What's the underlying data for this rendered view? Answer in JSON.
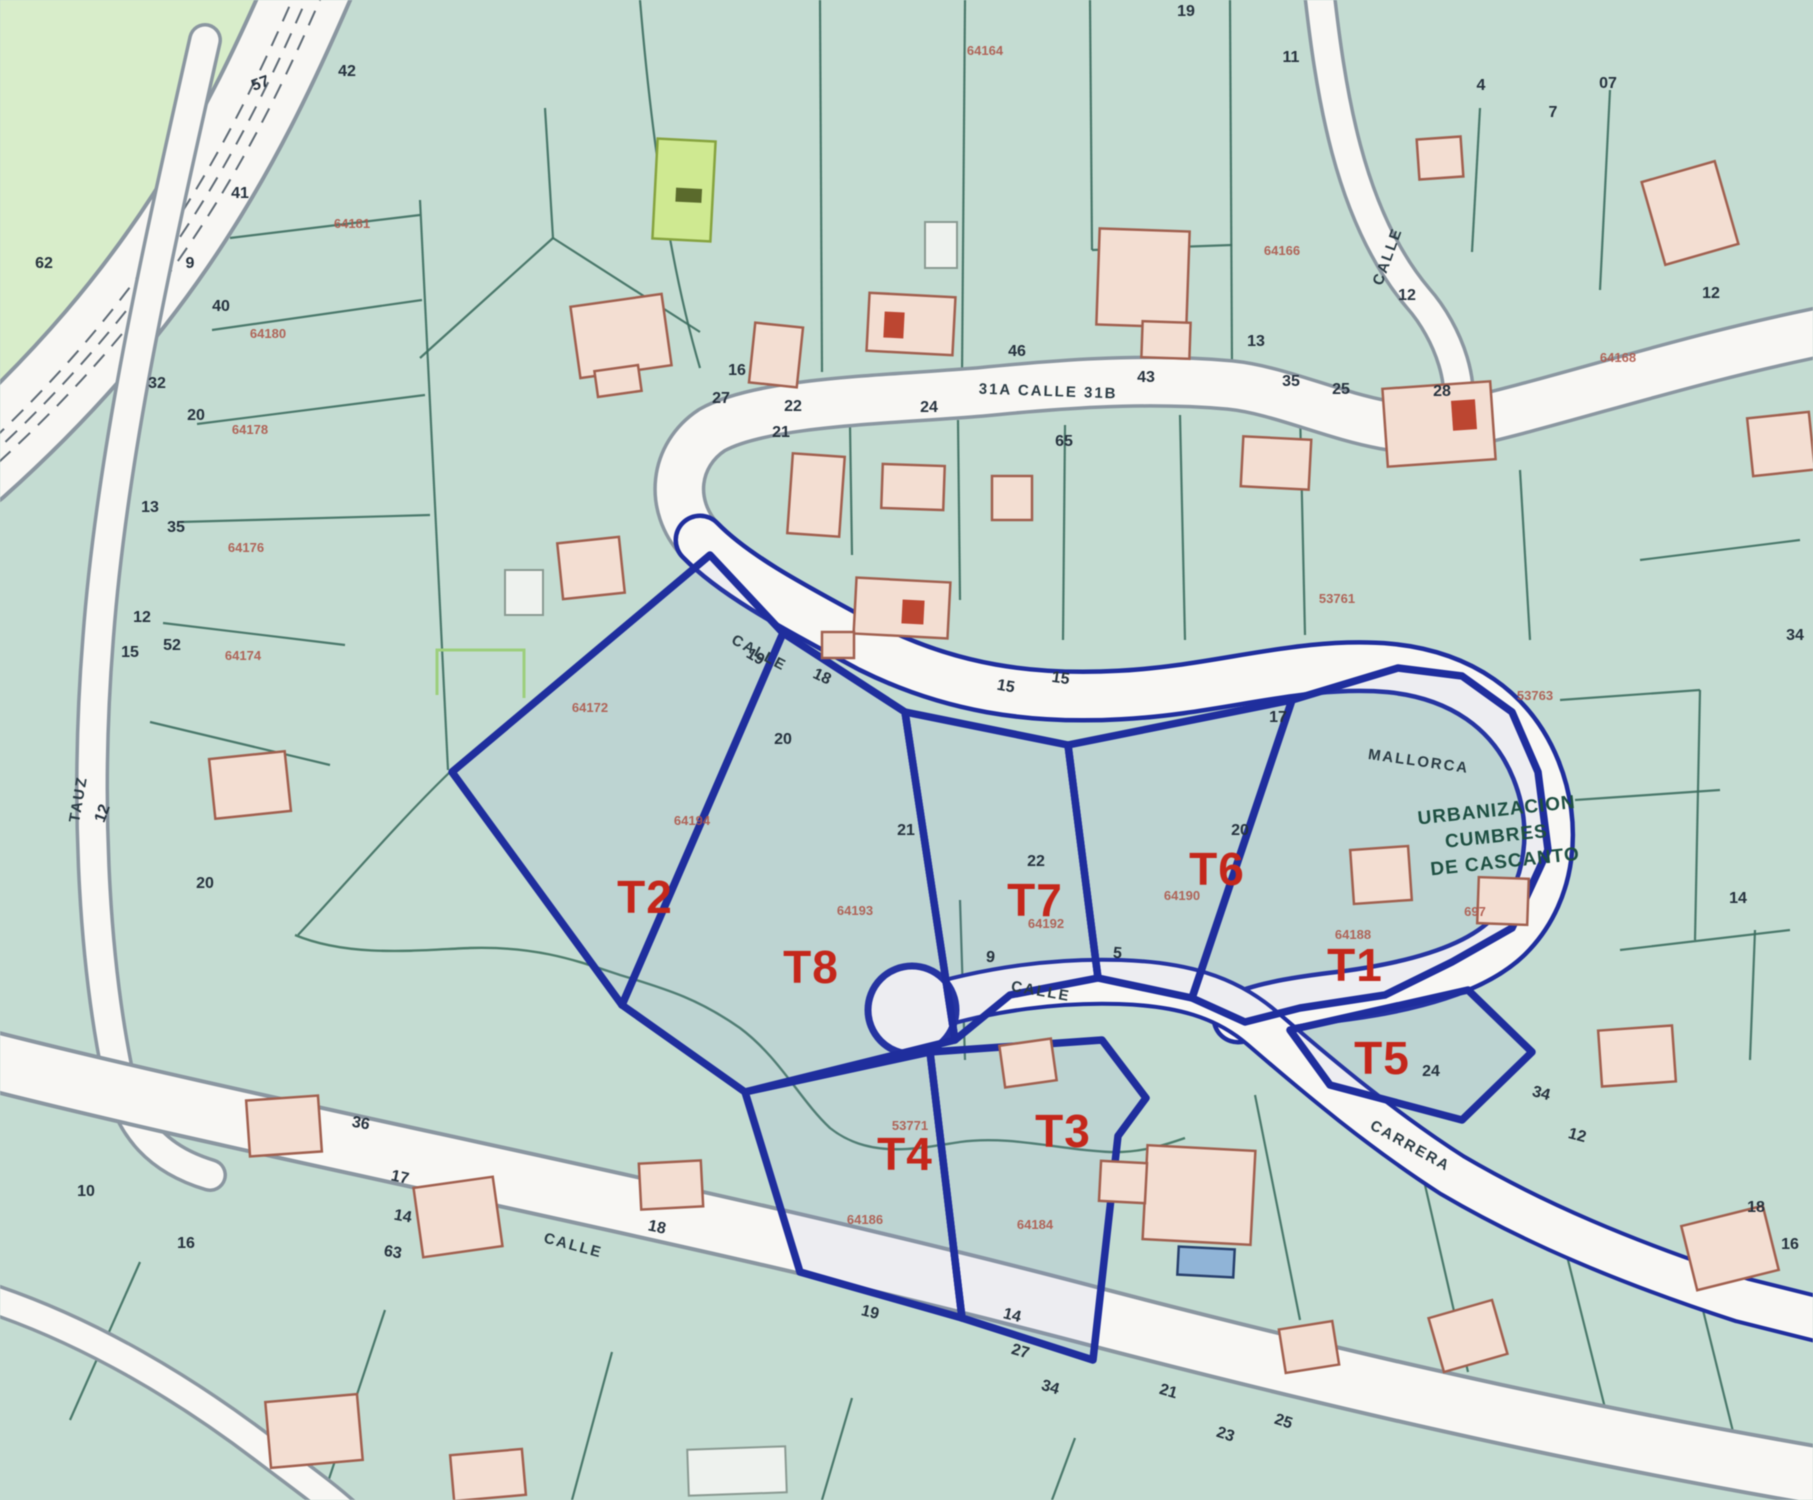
{
  "map": {
    "region_lines": [
      "URBANIZACION",
      "CUMBRES",
      "DE CASCANTO"
    ],
    "colors": {
      "background": "#c3dcd2",
      "road": "#f8f7f4",
      "plot_boundary_blue": "#1e2ea0",
      "plot_label_red": "#c8261a",
      "parcel_code_red": "#b0584a",
      "parcel_code_purple": "#8b7fd2",
      "building_fill": "#f4ded2",
      "building_stroke": "#a2604e",
      "highlight_parcel_green": "#cfe98f",
      "region_text_green": "#1d4f42"
    },
    "plot_labels": [
      {
        "t": "T1",
        "x": 1355,
        "y": 981
      },
      {
        "t": "T2",
        "x": 645,
        "y": 913
      },
      {
        "t": "T3",
        "x": 1063,
        "y": 1147
      },
      {
        "t": "T4",
        "x": 905,
        "y": 1170
      },
      {
        "t": "T5",
        "x": 1382,
        "y": 1074,
        "s": 42
      },
      {
        "t": "T6",
        "x": 1217,
        "y": 885
      },
      {
        "t": "T7",
        "x": 1035,
        "y": 916
      },
      {
        "t": "T8",
        "x": 811,
        "y": 983
      }
    ],
    "street_labels": [
      {
        "t": "CALLE",
        "x": 757,
        "y": 657,
        "r": 28
      },
      {
        "t": "31A CALLE 31B",
        "x": 1048,
        "y": 396,
        "r": 2
      },
      {
        "t": "MALLORCA",
        "x": 1418,
        "y": 766,
        "r": 8,
        "s": 20
      },
      {
        "t": "CALLE",
        "x": 1040,
        "y": 996,
        "r": 10
      },
      {
        "t": "CARRERA",
        "x": 1408,
        "y": 1150,
        "r": 29
      },
      {
        "t": "CALLE",
        "x": 572,
        "y": 1250,
        "r": 15,
        "s": 16
      },
      {
        "t": "CALLE",
        "x": 1392,
        "y": 258,
        "r": -70,
        "s": 14
      },
      {
        "t": "TAUZ",
        "x": 83,
        "y": 800,
        "r": -80,
        "s": 14
      }
    ],
    "street_numbers": [
      {
        "t": "57",
        "x": 262,
        "y": 88,
        "r": -20
      },
      {
        "t": "42",
        "x": 347,
        "y": 76
      },
      {
        "t": "41",
        "x": 240,
        "y": 198
      },
      {
        "t": "40",
        "x": 221,
        "y": 311
      },
      {
        "t": "20",
        "x": 196,
        "y": 420
      },
      {
        "t": "32",
        "x": 157,
        "y": 388
      },
      {
        "t": "13",
        "x": 150,
        "y": 512
      },
      {
        "t": "35",
        "x": 176,
        "y": 532
      },
      {
        "t": "12",
        "x": 142,
        "y": 622
      },
      {
        "t": "52",
        "x": 172,
        "y": 650
      },
      {
        "t": "15",
        "x": 130,
        "y": 657
      },
      {
        "t": "62",
        "x": 44,
        "y": 268
      },
      {
        "t": "9",
        "x": 190,
        "y": 268
      },
      {
        "t": "12",
        "x": 107,
        "y": 815,
        "r": -70
      },
      {
        "t": "20",
        "x": 205,
        "y": 888
      },
      {
        "t": "16",
        "x": 737,
        "y": 375
      },
      {
        "t": "27",
        "x": 721,
        "y": 403
      },
      {
        "t": "22",
        "x": 793,
        "y": 411
      },
      {
        "t": "21",
        "x": 781,
        "y": 437
      },
      {
        "t": "24",
        "x": 929,
        "y": 412
      },
      {
        "t": "46",
        "x": 1017,
        "y": 356
      },
      {
        "t": "65",
        "x": 1064,
        "y": 446
      },
      {
        "t": "13",
        "x": 1256,
        "y": 346
      },
      {
        "t": "43",
        "x": 1146,
        "y": 382
      },
      {
        "t": "35",
        "x": 1291,
        "y": 386
      },
      {
        "t": "25",
        "x": 1341,
        "y": 394
      },
      {
        "t": "28",
        "x": 1442,
        "y": 396
      },
      {
        "t": "12",
        "x": 1407,
        "y": 300
      },
      {
        "t": "11",
        "x": 1291,
        "y": 62
      },
      {
        "t": "19",
        "x": 1186,
        "y": 16
      },
      {
        "t": "07",
        "x": 1608,
        "y": 88
      },
      {
        "t": "4",
        "x": 1481,
        "y": 90
      },
      {
        "t": "7",
        "x": 1553,
        "y": 117
      },
      {
        "t": "12",
        "x": 1711,
        "y": 298
      },
      {
        "t": "34",
        "x": 1795,
        "y": 640
      },
      {
        "t": "19",
        "x": 753,
        "y": 661,
        "r": 30
      },
      {
        "t": "18",
        "x": 820,
        "y": 681,
        "r": 25
      },
      {
        "t": "15",
        "x": 1005,
        "y": 691,
        "r": 10
      },
      {
        "t": "15",
        "x": 1060,
        "y": 683,
        "r": 8
      },
      {
        "t": "17",
        "x": 1278,
        "y": 722
      },
      {
        "t": "20",
        "x": 783,
        "y": 744
      },
      {
        "t": "20",
        "x": 1240,
        "y": 835
      },
      {
        "t": "21",
        "x": 906,
        "y": 835
      },
      {
        "t": "22",
        "x": 1036,
        "y": 866
      },
      {
        "t": "24",
        "x": 1431,
        "y": 1076
      },
      {
        "t": "34",
        "x": 1540,
        "y": 1098,
        "r": 15
      },
      {
        "t": "12",
        "x": 1576,
        "y": 1140,
        "r": 15
      },
      {
        "t": "14",
        "x": 1738,
        "y": 903
      },
      {
        "t": "9",
        "x": 990,
        "y": 962,
        "r": 5
      },
      {
        "t": "5",
        "x": 1117,
        "y": 958,
        "r": 5
      },
      {
        "t": "36",
        "x": 360,
        "y": 1128,
        "r": 10
      },
      {
        "t": "17",
        "x": 399,
        "y": 1182,
        "r": 12
      },
      {
        "t": "14",
        "x": 402,
        "y": 1221,
        "r": 10
      },
      {
        "t": "63",
        "x": 392,
        "y": 1257,
        "r": 10
      },
      {
        "t": "10",
        "x": 86,
        "y": 1196
      },
      {
        "t": "16",
        "x": 186,
        "y": 1248
      },
      {
        "t": "18",
        "x": 656,
        "y": 1232,
        "r": 12
      },
      {
        "t": "19",
        "x": 869,
        "y": 1317,
        "r": 14
      },
      {
        "t": "14",
        "x": 1011,
        "y": 1320,
        "r": 14
      },
      {
        "t": "27",
        "x": 1019,
        "y": 1356,
        "r": 16
      },
      {
        "t": "34",
        "x": 1049,
        "y": 1392,
        "r": 16
      },
      {
        "t": "21",
        "x": 1167,
        "y": 1396,
        "r": 16
      },
      {
        "t": "23",
        "x": 1224,
        "y": 1439,
        "r": 18
      },
      {
        "t": "25",
        "x": 1282,
        "y": 1426,
        "r": 18
      },
      {
        "t": "18",
        "x": 1756,
        "y": 1212
      },
      {
        "t": "16",
        "x": 1790,
        "y": 1249
      }
    ],
    "parcel_codes": [
      {
        "t": "64181",
        "x": 352,
        "y": 228
      },
      {
        "t": "64180",
        "x": 268,
        "y": 338
      },
      {
        "t": "64178",
        "x": 250,
        "y": 434
      },
      {
        "t": "64176",
        "x": 246,
        "y": 552
      },
      {
        "t": "64174",
        "x": 243,
        "y": 660
      },
      {
        "t": "64172",
        "x": 590,
        "y": 712
      },
      {
        "t": "64164",
        "x": 985,
        "y": 55
      },
      {
        "t": "64166",
        "x": 1282,
        "y": 255
      },
      {
        "t": "64168",
        "x": 1618,
        "y": 362
      },
      {
        "t": "64194",
        "x": 692,
        "y": 825
      },
      {
        "t": "64193",
        "x": 855,
        "y": 915
      },
      {
        "t": "64192",
        "x": 1046,
        "y": 928
      },
      {
        "t": "64190",
        "x": 1182,
        "y": 900
      },
      {
        "t": "64188",
        "x": 1353,
        "y": 939
      },
      {
        "t": "64186",
        "x": 865,
        "y": 1224
      },
      {
        "t": "64184",
        "x": 1035,
        "y": 1229
      },
      {
        "t": "697",
        "x": 1475,
        "y": 916,
        "c": "#a03c30",
        "s": 20
      },
      {
        "t": "53763",
        "x": 1535,
        "y": 700,
        "c": "#8b7fd2"
      },
      {
        "t": "53761",
        "x": 1337,
        "y": 603,
        "c": "#8b7fd2"
      },
      {
        "t": "53771",
        "x": 910,
        "y": 1130,
        "c": "#8b7fd2",
        "s": 15
      }
    ]
  }
}
